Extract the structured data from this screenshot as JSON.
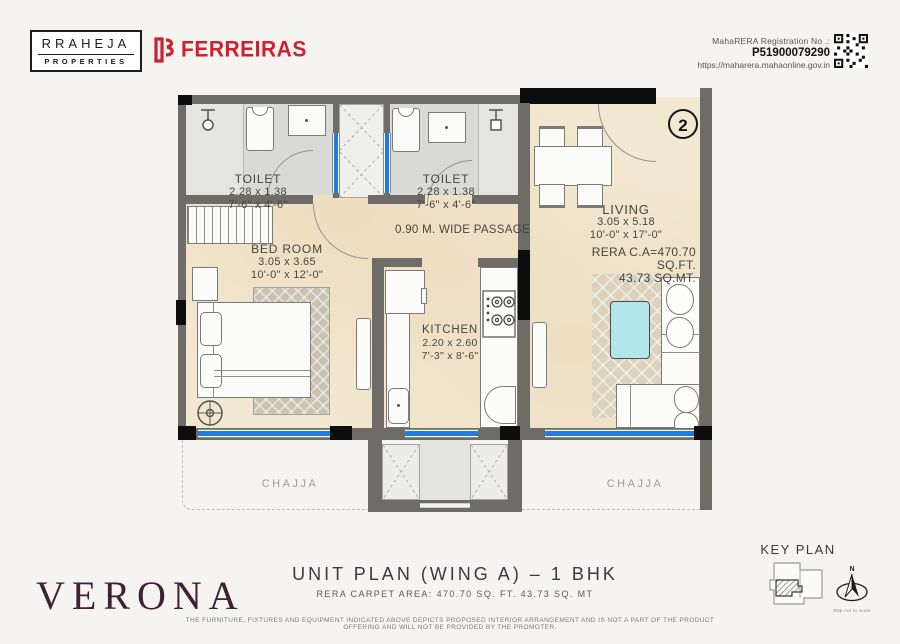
{
  "header": {
    "brand_line1": "RRAHEJA",
    "brand_line2": "PROPERTIES",
    "partner_logo": "FERREIRAS",
    "rera_label": "MahaRERA Registration No .:",
    "rera_number": "P51900079290",
    "rera_url": "https://maharera.mahaonline.gov.in"
  },
  "plan": {
    "unit_number": "2",
    "passage_label": "0.90 M. WIDE PASSAGE",
    "rooms": {
      "toilet1": {
        "name": "TOILET",
        "dim_m": "2.28 x 1.38",
        "dim_ft": "7'-6\" x 4'-6\""
      },
      "toilet2": {
        "name": "TOILET",
        "dim_m": "2.28 x 1.38",
        "dim_ft": "7'-6\" x 4'-6\""
      },
      "bedroom": {
        "name": "BED ROOM",
        "dim_m": "3.05 x 3.65",
        "dim_ft": "10'-0\" x 12'-0\""
      },
      "kitchen": {
        "name": "KITCHEN",
        "dim_m": "2.20 x 2.60",
        "dim_ft": "7'-3\" x 8'-6\""
      },
      "living": {
        "name": "LIVING",
        "dim_m": "3.05 x 5.18",
        "dim_ft": "10'-0\" x 17'-0\""
      }
    },
    "rera_area_line1": "RERA C.A=470.70 SQ.FT.",
    "rera_area_line2": "43.73 SQ.MT.",
    "chajja_left": "CHAJJA",
    "chajja_right": "CHAJJA"
  },
  "footer": {
    "project_name": "VERONA",
    "plan_title": "UNIT PLAN (WING A) – 1 BHK",
    "plan_subtitle": "RERA CARPET AREA: 470.70 SQ. FT. 43.73 SQ. MT",
    "disclaimer": "THE FURNITURE, FIXTURES AND EQUIPMENT INDICATED ABOVE DEPICTS PROPOSED INTERIOR ARRANGEMENT AND IS NOT A PART OF THE PRODUCT OFFERING AND WILL NOT BE PROVIDED BY THE PROMOTER.",
    "keyplan_label": "KEY PLAN",
    "compass_n": "N",
    "compass_note": "Map not to scale"
  },
  "colors": {
    "accent_red": "#cf2030",
    "project_maroon": "#3f2133",
    "window_blue": "#1f7ce2",
    "floor_beige": "#f2e7d0",
    "wall_gray": "#6f6b67"
  }
}
